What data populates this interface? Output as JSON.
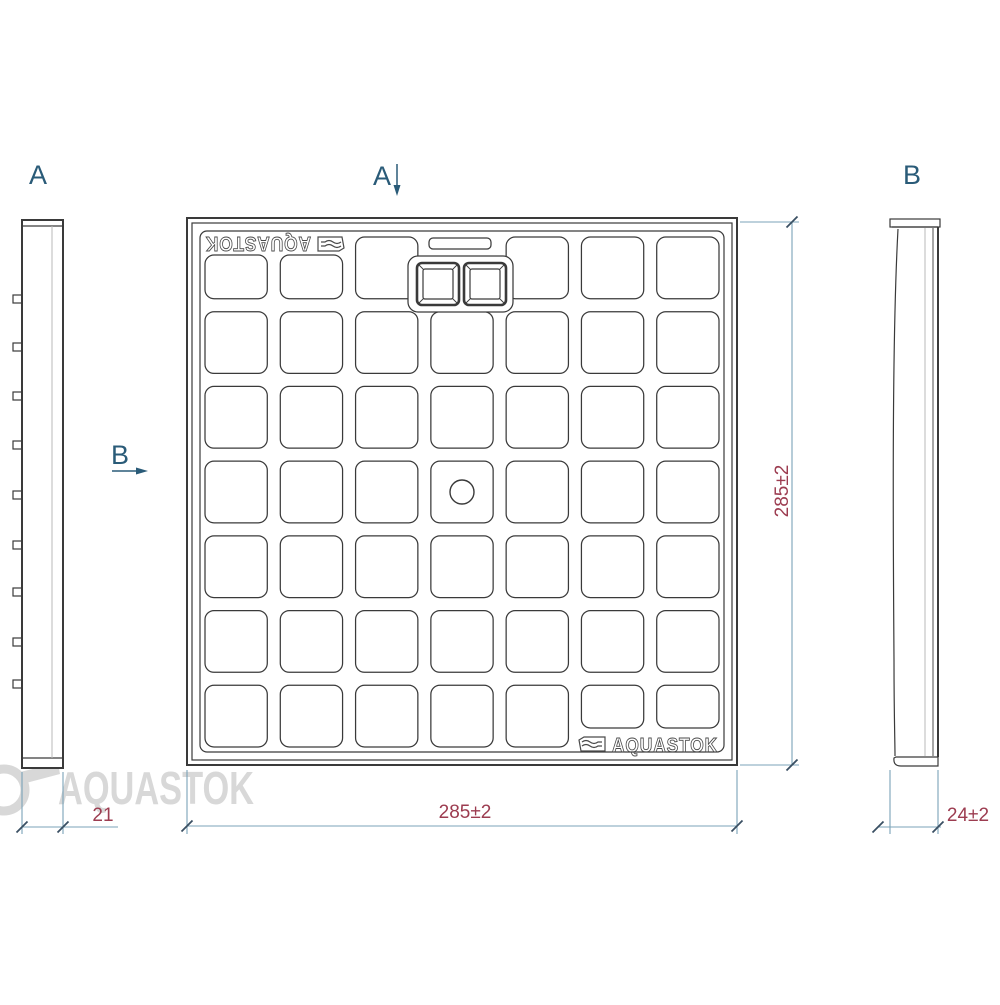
{
  "drawing": {
    "brand": "AQUASTOK",
    "watermark_text": "AQUASTOK",
    "logo_top_left": "AQUASTOK",
    "logo_bottom_right": "AQUASTOK",
    "view_labels": {
      "a": "A",
      "b": "B"
    },
    "views": {
      "side_a": {
        "label": "A",
        "tab_count": 9
      },
      "top": {
        "grid_rows": 7,
        "grid_cols": 7,
        "handle_openings": 2,
        "center_hole": 1
      },
      "side_b": {
        "label": "B"
      }
    },
    "dimensions": {
      "side_a_thickness": "21",
      "top_width": "285±2",
      "top_height": "285±2",
      "side_b_thickness": "24±2"
    },
    "colors": {
      "line": "#3a3a3a",
      "dimension_line": "#7ba3b8",
      "dimension_text": "#9c3c50",
      "view_label": "#2a5b78",
      "tick": "#3a4f63",
      "watermark": "#d8d8d8"
    }
  }
}
